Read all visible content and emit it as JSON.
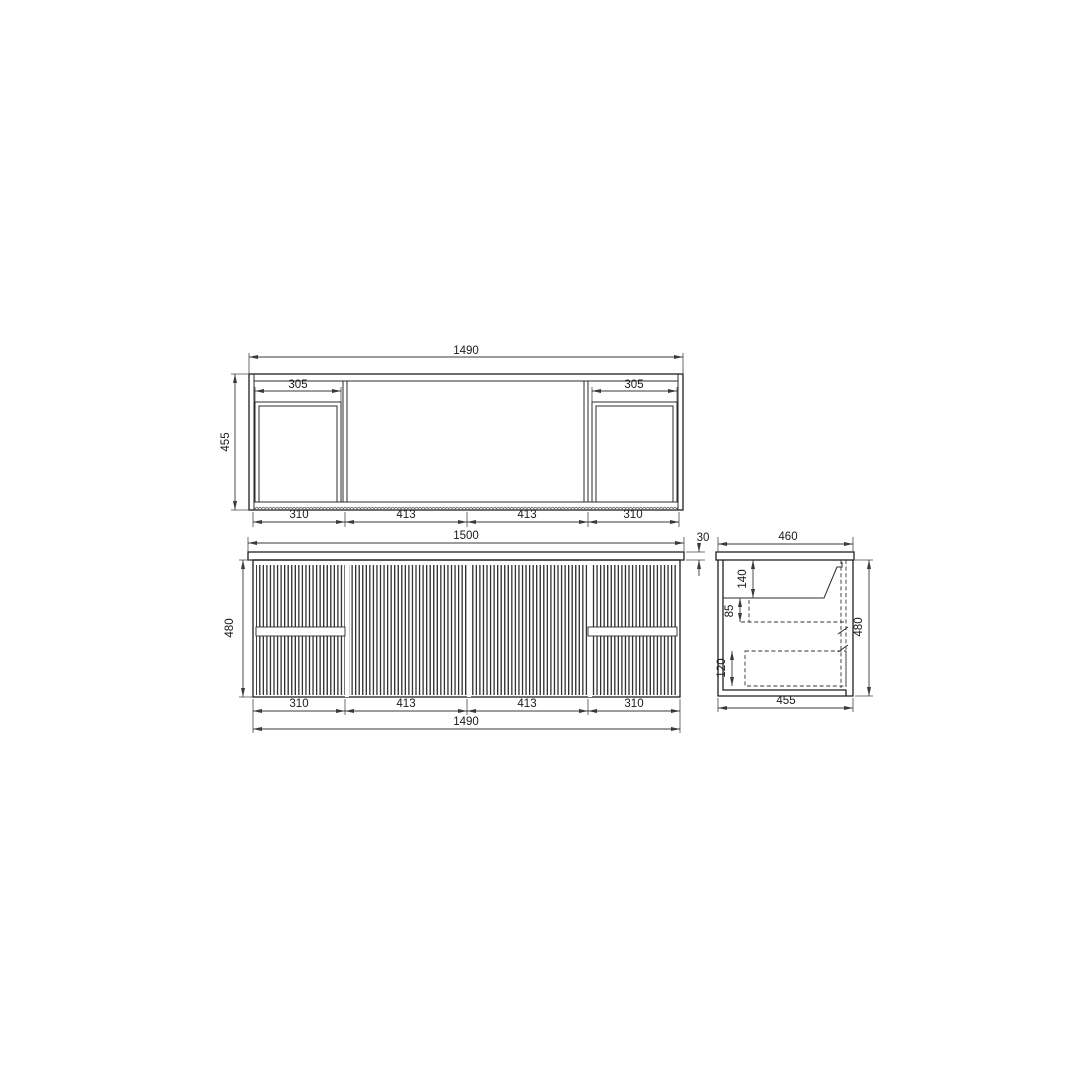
{
  "colors": {
    "background": "#ffffff",
    "line": "#1f1f1f",
    "dim_line": "#3a3a3a",
    "text": "#1a1a1a"
  },
  "plan_view": {
    "overall_width": "1490",
    "depth": "455",
    "left_opening_width": "305",
    "right_opening_width": "305",
    "seg_1": "310",
    "seg_2": "413",
    "seg_3": "413",
    "seg_4": "310"
  },
  "front_view": {
    "countertop_width": "1500",
    "countertop_thickness": "30",
    "height": "480",
    "seg_1": "310",
    "seg_2": "413",
    "seg_3": "413",
    "seg_4": "310",
    "cabinet_width": "1490"
  },
  "side_view": {
    "countertop_depth": "460",
    "basin_depth": "140",
    "under_basin_gap": "85",
    "drawer_height": "120",
    "height": "480",
    "cabinet_depth": "455"
  }
}
